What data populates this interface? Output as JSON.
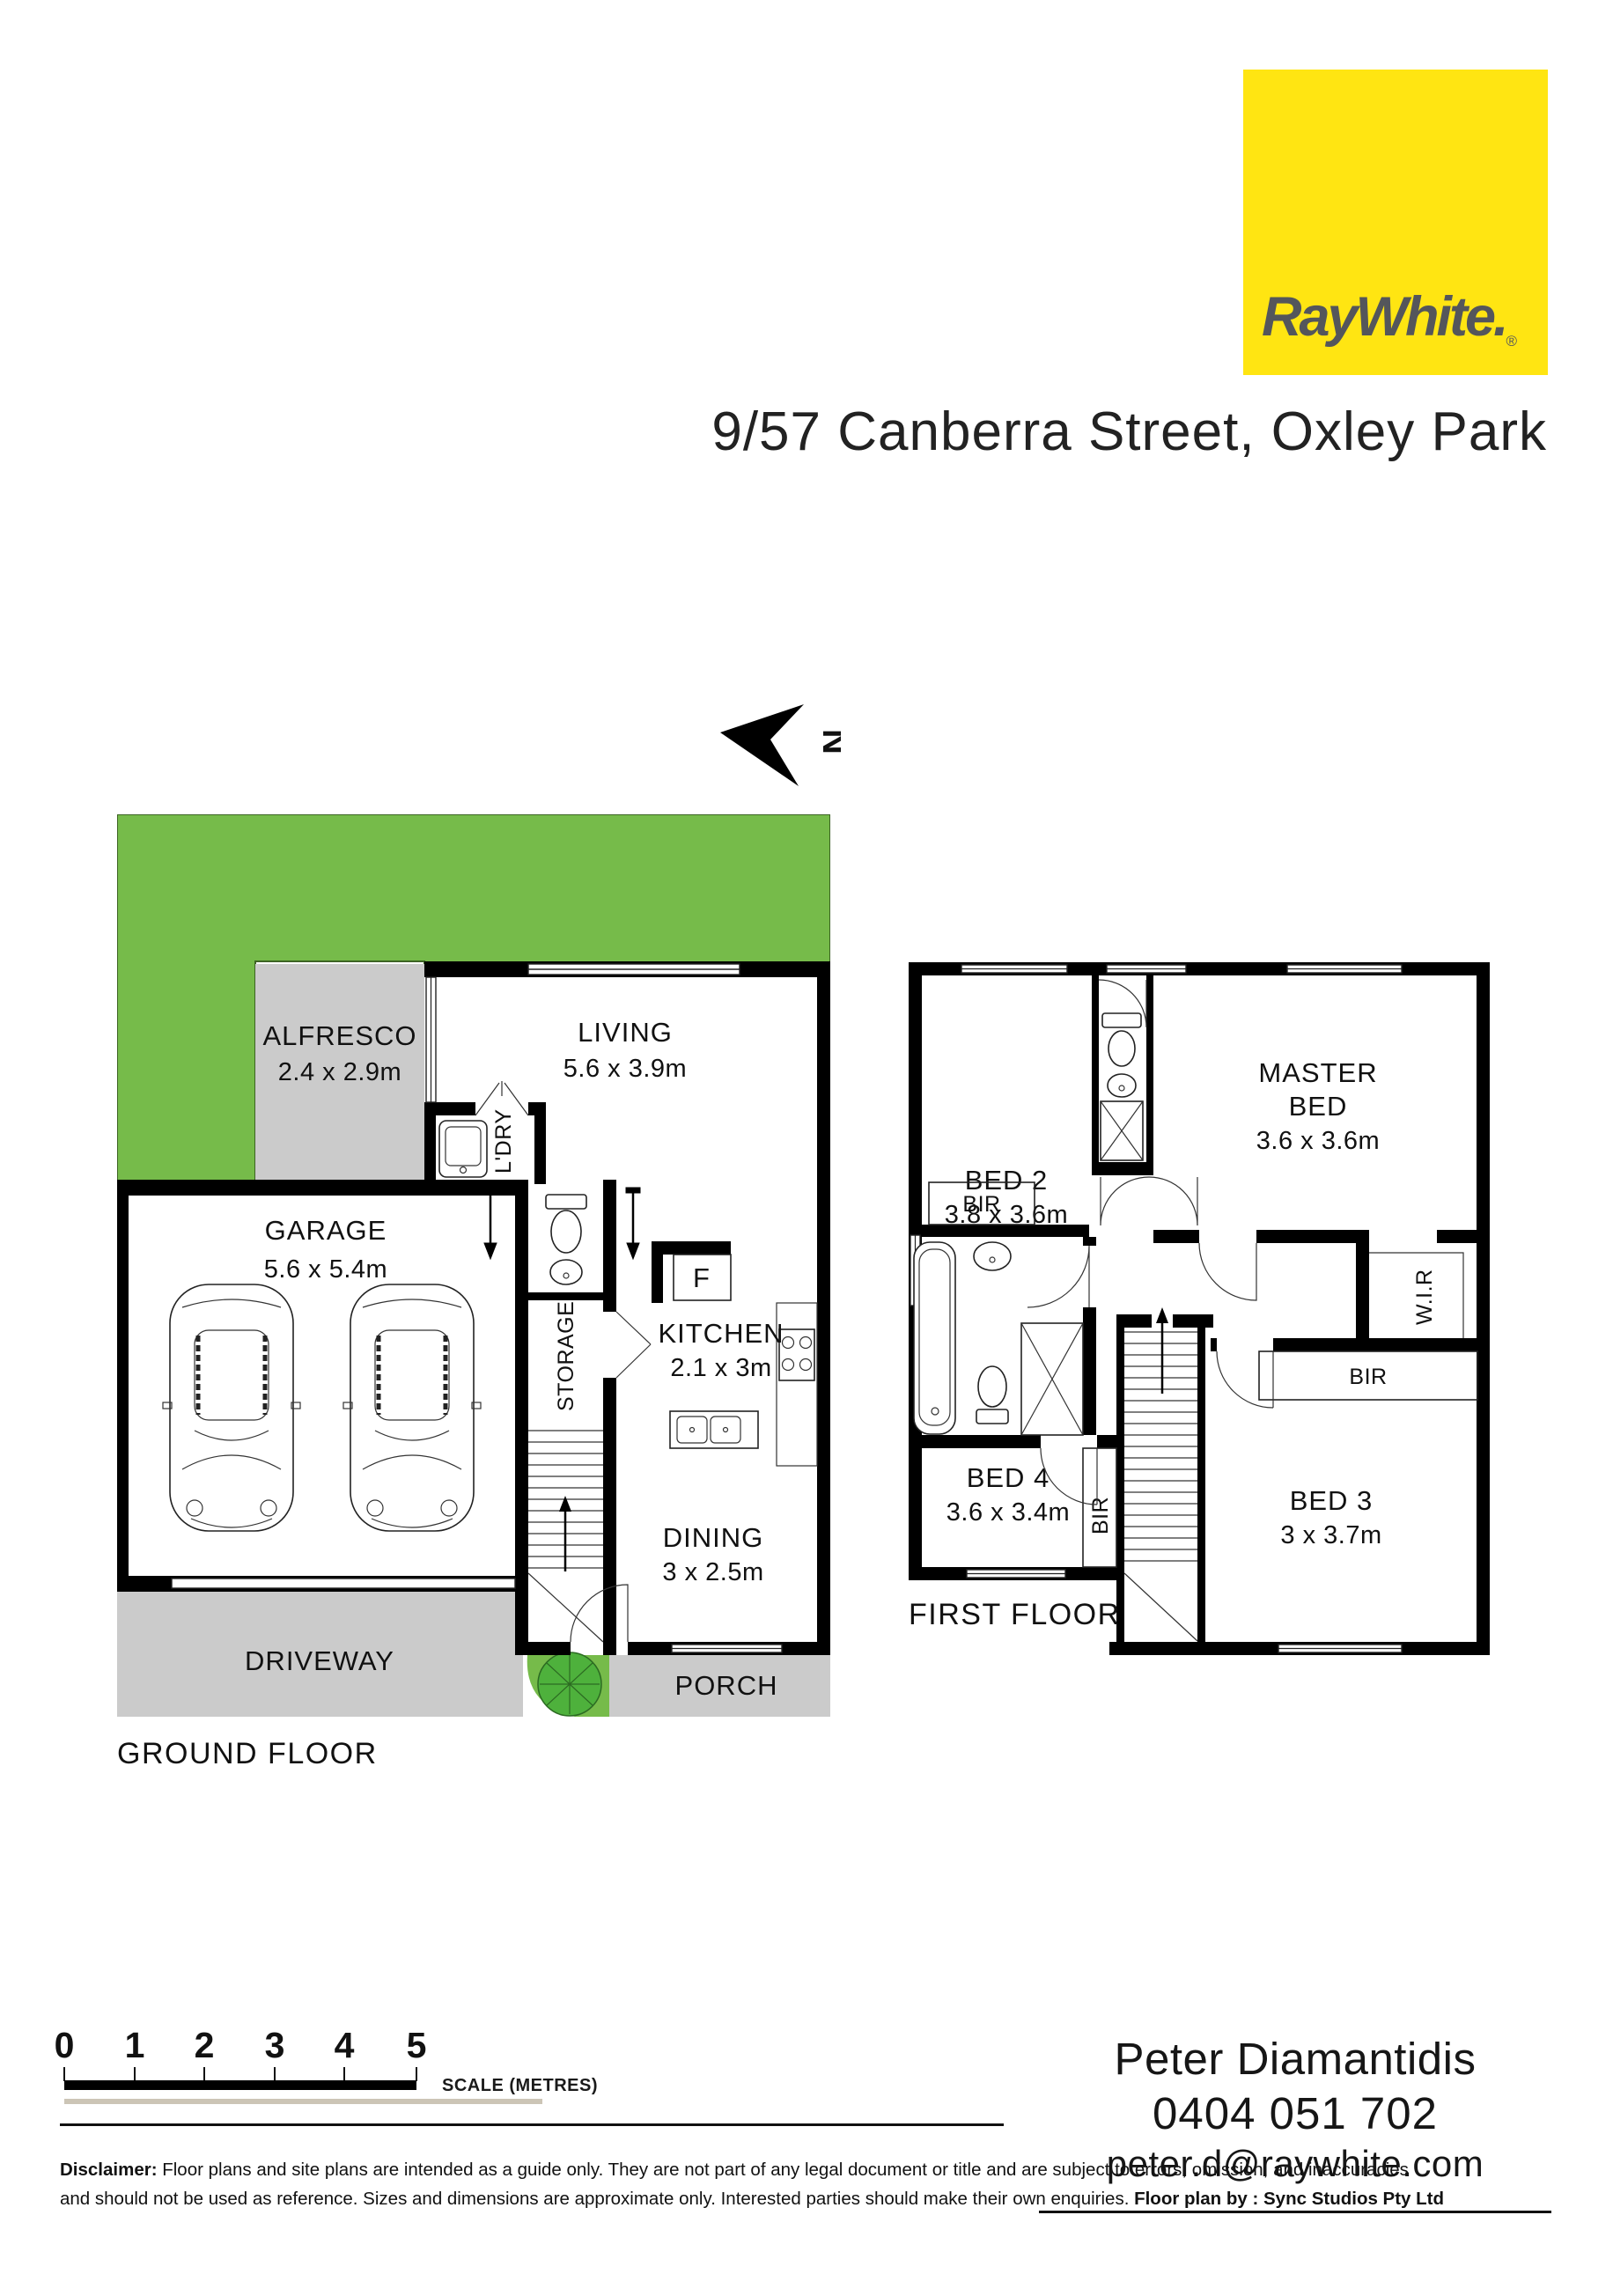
{
  "brand": {
    "logo_text": "RayWhite",
    "logo_period": ".",
    "registered_mark": "®",
    "yellow": "#FFE512",
    "logo_text_color": "#54565B"
  },
  "header": {
    "title": "9/57 Canberra Street, Oxley Park"
  },
  "compass": {
    "north_label": "N"
  },
  "ground_floor": {
    "floor_label": "GROUND FLOOR",
    "rooms": {
      "alfresco": {
        "name": "ALFRESCO",
        "dims": "2.4 x 2.9m"
      },
      "living": {
        "name": "LIVING",
        "dims": "5.6 x 3.9m"
      },
      "garage": {
        "name": "GARAGE",
        "dims": "5.6 x 5.4m"
      },
      "kitchen": {
        "name": "KITCHEN",
        "dims": "2.1 x 3m"
      },
      "dining": {
        "name": "DINING",
        "dims": "3 x 2.5m"
      },
      "laundry": "L'DRY",
      "storage": "STORAGE",
      "driveway": "DRIVEWAY",
      "porch": "PORCH",
      "fridge": "F"
    }
  },
  "first_floor": {
    "floor_label": "FIRST FLOOR",
    "rooms": {
      "bed2": {
        "name": "BED 2",
        "dims": "3.8 x 3.6m"
      },
      "master_bed": {
        "name_line1": "MASTER",
        "name_line2": "BED",
        "dims": "3.6 x 3.6m"
      },
      "bed3": {
        "name": "BED 3",
        "dims": "3 x 3.7m"
      },
      "bed4": {
        "name": "BED 4",
        "dims": "3.6 x 3.4m"
      },
      "bir": "BIR",
      "wir": "W.I.R"
    }
  },
  "scale_bar": {
    "ticks": [
      "0",
      "1",
      "2",
      "3",
      "4",
      "5"
    ],
    "label": "SCALE (METRES)"
  },
  "agent": {
    "name": "Peter Diamantidis",
    "phone": "0404 051 702",
    "email": "peter.d@raywhite.com"
  },
  "disclaimer": {
    "prefix": "Disclaimer:",
    "line1_rest": " Floor plans and site plans are intended as a guide only. They are not part of any legal document or title and are subject to errors, omission, and inaccuracies",
    "line2_text": "and should not be used as reference. Sizes and dimensions are approximate only. Interested parties should make their own enquiries. ",
    "line2_bold": "Floor plan by : Sync Studios Pty Ltd"
  },
  "colors": {
    "garden_green": "#76BB4A",
    "tree_green": "#4EB13C",
    "surface_gray": "#CBCBCB",
    "wall_black": "#000000"
  }
}
